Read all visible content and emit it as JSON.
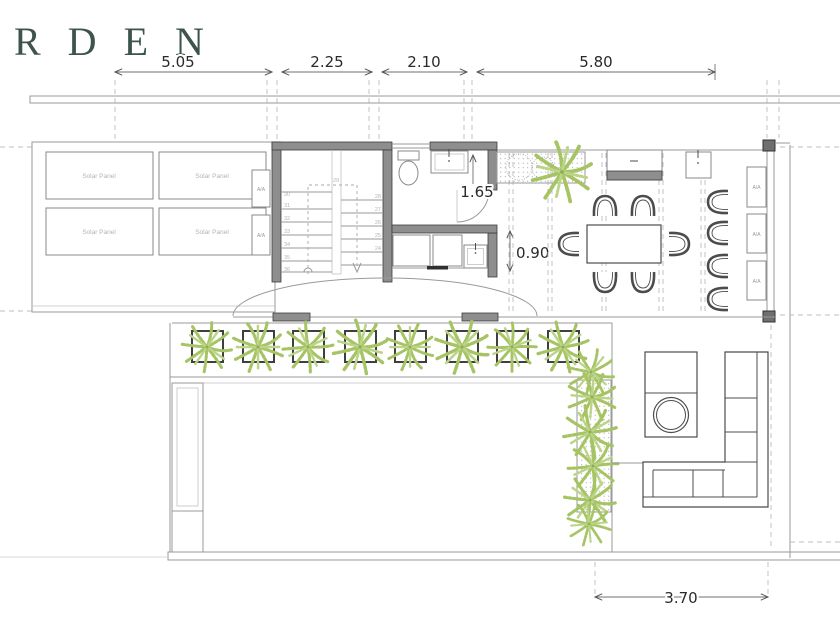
{
  "title": "RDEN",
  "dimensions": {
    "top": [
      "5.05",
      "2.25",
      "2.10",
      "5.80"
    ],
    "door_width": "1.65",
    "opening_width": "0.90",
    "bottom_width": "3.70"
  },
  "labels": {
    "solar_panel": "Solar Panel",
    "ac_unit": "A/A"
  },
  "stairs": {
    "steps_left": [
      "30",
      "31",
      "32",
      "33",
      "34",
      "35",
      "36"
    ],
    "step_top": "29",
    "steps_right": [
      "28",
      "27",
      "26",
      "25",
      "24"
    ]
  },
  "colors": {
    "title": "#3d544d",
    "wall_fill": "#8e8e8e",
    "wall_stroke": "#3d3d3d",
    "thin_line": "#9a9a9a",
    "plant_green": "#a6c464",
    "dim_text": "#2a2a2a",
    "faint_label": "#b3b3b3"
  }
}
